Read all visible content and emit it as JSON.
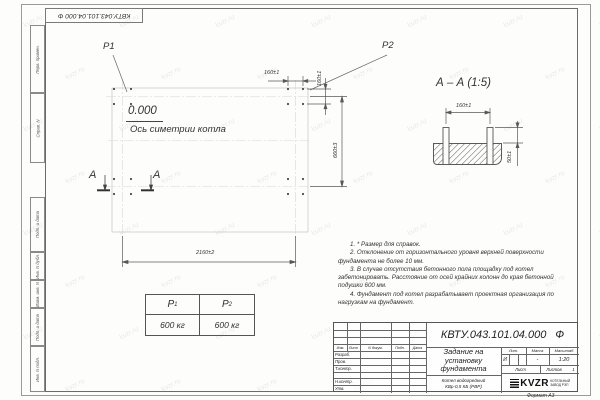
{
  "sheet": {
    "top_designation": "КВТУ.043.101.04.000 Ф",
    "format_label": "Формат А3",
    "margin_labels": [
      "Перв. примен.",
      "Справ. N",
      "Подп. и дата",
      "Инв. N дубл.",
      "Взам. инв. N",
      "Подп. и дата",
      "Инв. N подл."
    ],
    "watermark": "kvzr.ru"
  },
  "plan": {
    "p1_label": "P1",
    "p2_label": "P2",
    "level_mark": "0.000",
    "axis_label": "Ось симетрии котла",
    "section_letter": "А",
    "dims": {
      "bolt_spacing_h": "160±1",
      "bolt_spacing_v": "160±1",
      "row_spacing": "660±3",
      "col_spacing": "2160±2"
    }
  },
  "section": {
    "title": "А – А (1:5)",
    "dims": {
      "bolt_spacing": "160±1",
      "bolt_height": "50±1"
    }
  },
  "load_table": {
    "headers": [
      {
        "base": "P",
        "sub": "1"
      },
      {
        "base": "P",
        "sub": "2"
      }
    ],
    "values": [
      "600 кг",
      "600 кг"
    ]
  },
  "notes": [
    "1. * Размер для справок.",
    "2. Отклонение от горизонтального уровня верхней поверхности фундамента не более 10 мм.",
    "3. В случае отсутствия бетонного пола площадку под котел забетонировать. Расстояние от осей крайних колонн до края бетонной подушки 600 мм.",
    "4. Фундамент под котел разрабатывает проектная организация по нагрузкам на фундамент."
  ],
  "title_block": {
    "designation": "КВТУ.043.101.04.000 Ф",
    "doc_title_lines": [
      "Задание на",
      "установку",
      "фундамента"
    ],
    "product_lines": [
      "Котел водогрейный",
      "КВр-0,5 КБ (РВР)"
    ],
    "header_cols": [
      "Изм.",
      "Лист",
      "N докум.",
      "Подп.",
      "Дата"
    ],
    "row_labels": [
      "Разраб.",
      "Пров.",
      "Т.контр.",
      "",
      "Н.контр.",
      "Утв."
    ],
    "lit_header": "Лит.",
    "mass_header": "Масса",
    "scale_header": "Масштаб",
    "lit_value": "И",
    "mass_value": "-",
    "scale_value": "1:20",
    "sheet_label": "Лист",
    "sheets_label": "Листов",
    "sheets_value": "1",
    "logo_text": "KVZR",
    "logo_caption_lines": [
      "КОТЕЛЬНЫЙ",
      "ЗАВОД РЭП"
    ]
  }
}
